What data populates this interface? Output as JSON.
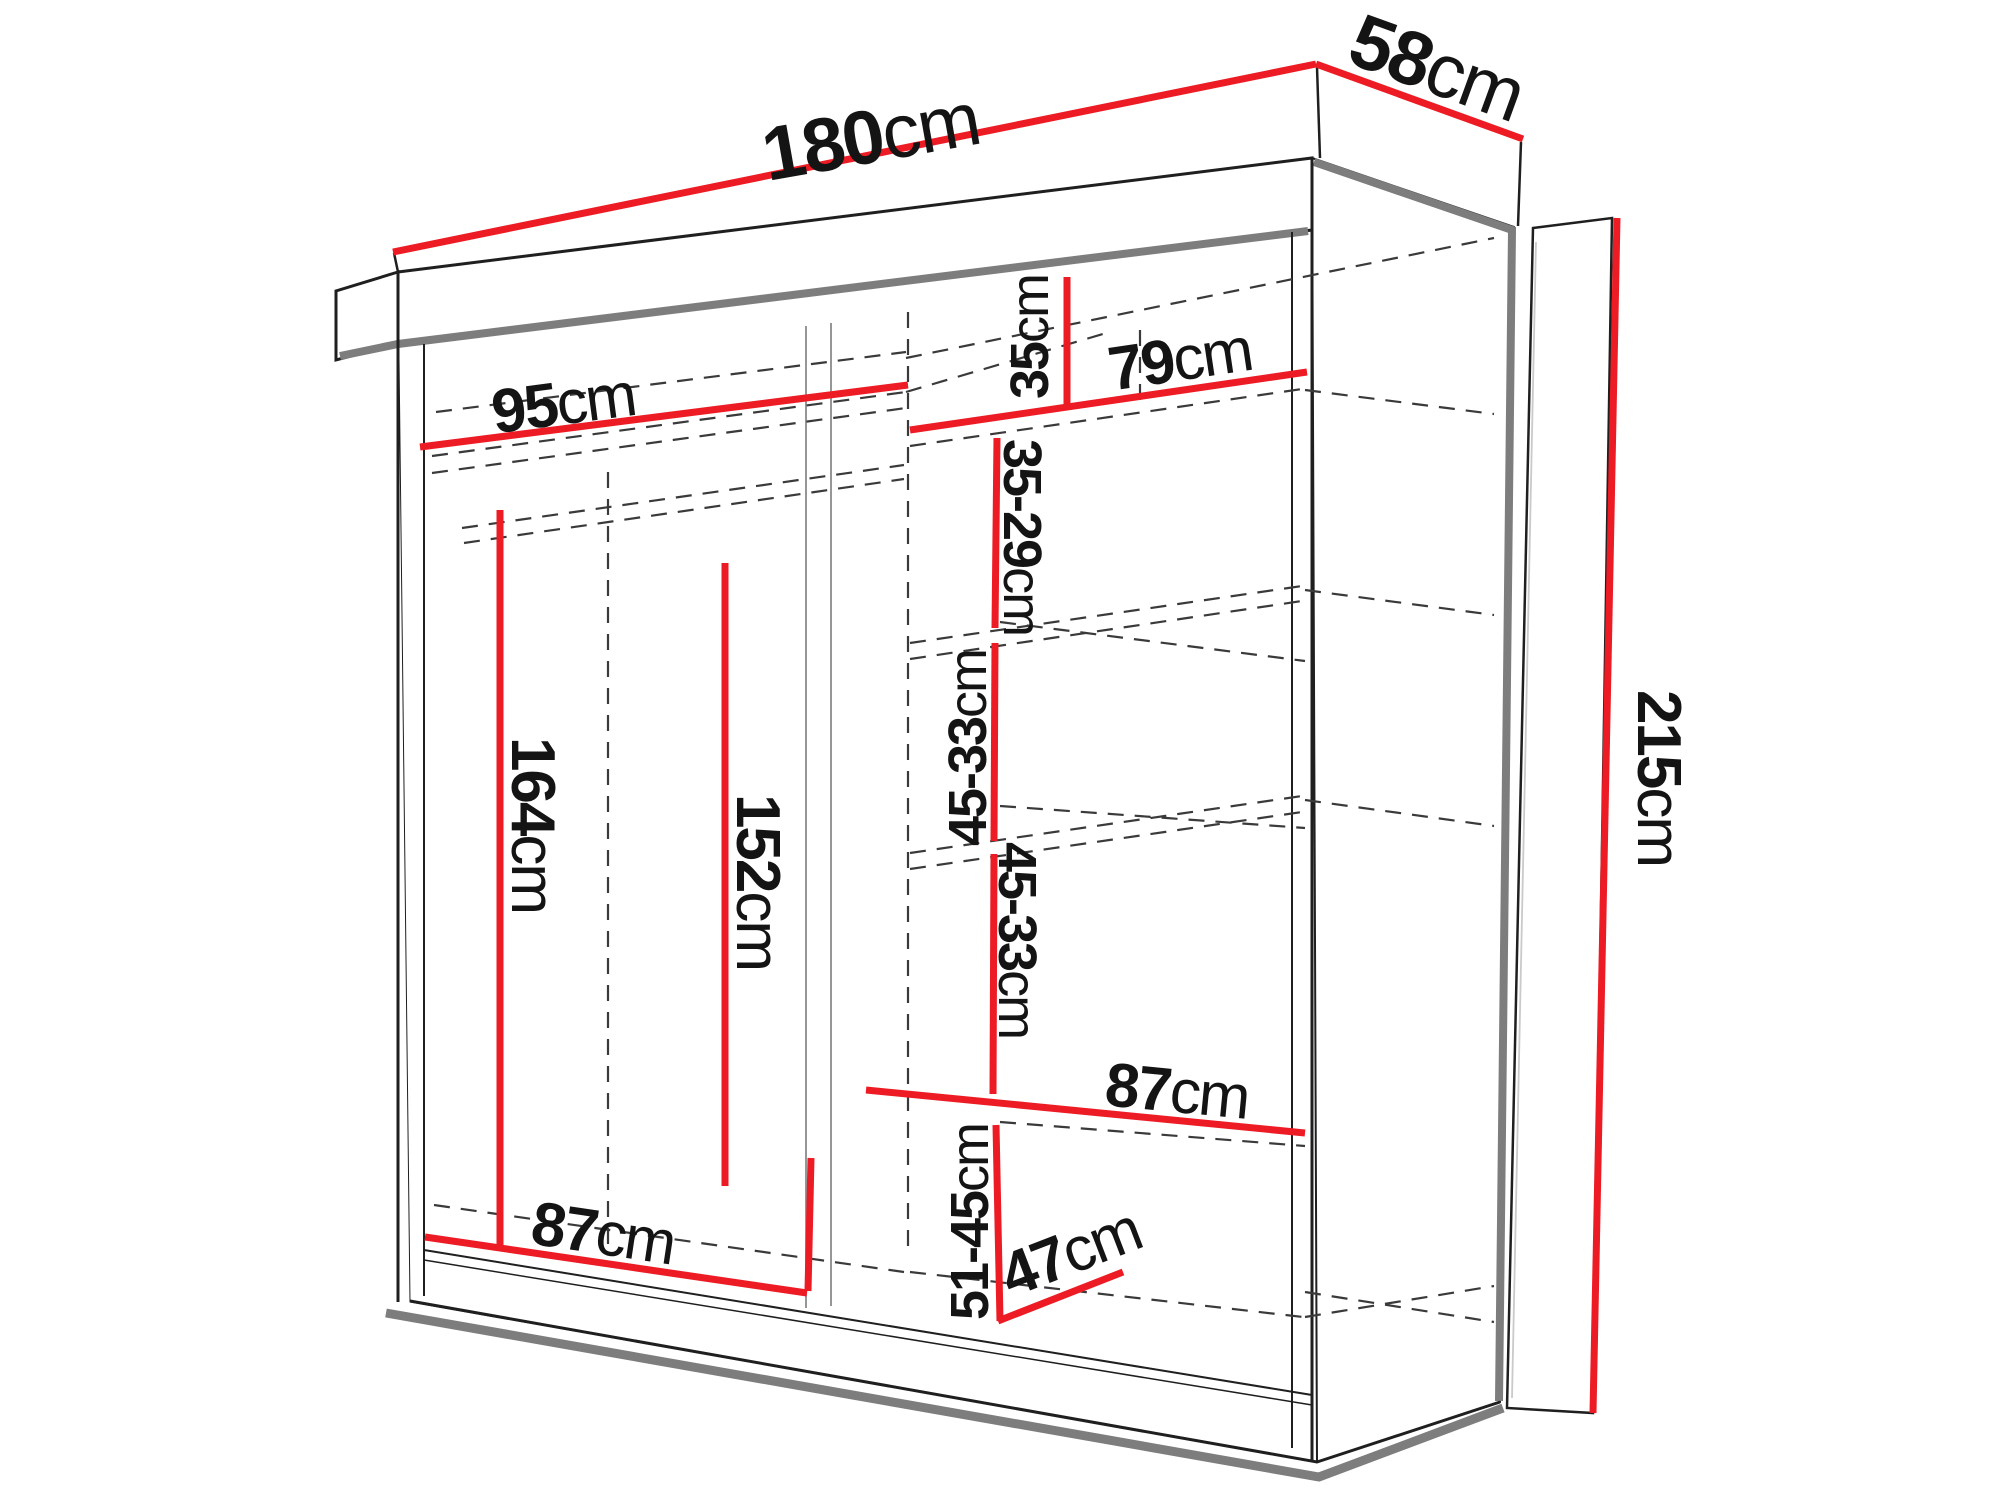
{
  "diagram": {
    "kind": "wardrobe-dimension-drawing",
    "description": "Perspective line drawing of a two-door sliding wardrobe with red dimension lines and internal shelf measurements",
    "background": "#ffffff"
  },
  "colors": {
    "dimension_red": "#ed1b24",
    "outline_black": "#1f1f1f",
    "shadow_gray": "#7d7d7d",
    "hidden_line_gray": "#3a3a3a"
  },
  "dims": {
    "width": {
      "value": "180",
      "unit": "cm"
    },
    "depth": {
      "value": "58",
      "unit": "cm"
    },
    "height": {
      "value": "215",
      "unit": "cm"
    },
    "left_section_width": {
      "value": "95",
      "unit": "cm"
    },
    "right_section_width": {
      "value": "79",
      "unit": "cm"
    },
    "top_shelf_height": {
      "value": "35",
      "unit": "cm"
    },
    "shelf_gap_1": {
      "value": "35-29",
      "unit": "cm"
    },
    "shelf_gap_2": {
      "value": "45-33",
      "unit": "cm"
    },
    "shelf_gap_3": {
      "value": "45-33",
      "unit": "cm"
    },
    "left_hanging_height": {
      "value": "164",
      "unit": "cm"
    },
    "mid_hanging_height": {
      "value": "152",
      "unit": "cm"
    },
    "right_shelf_width": {
      "value": "87",
      "unit": "cm"
    },
    "bottom_section_width": {
      "value": "87",
      "unit": "cm"
    },
    "bottom_gap": {
      "value": "51-45",
      "unit": "cm"
    },
    "bottom_depth": {
      "value": "47",
      "unit": "cm"
    }
  }
}
